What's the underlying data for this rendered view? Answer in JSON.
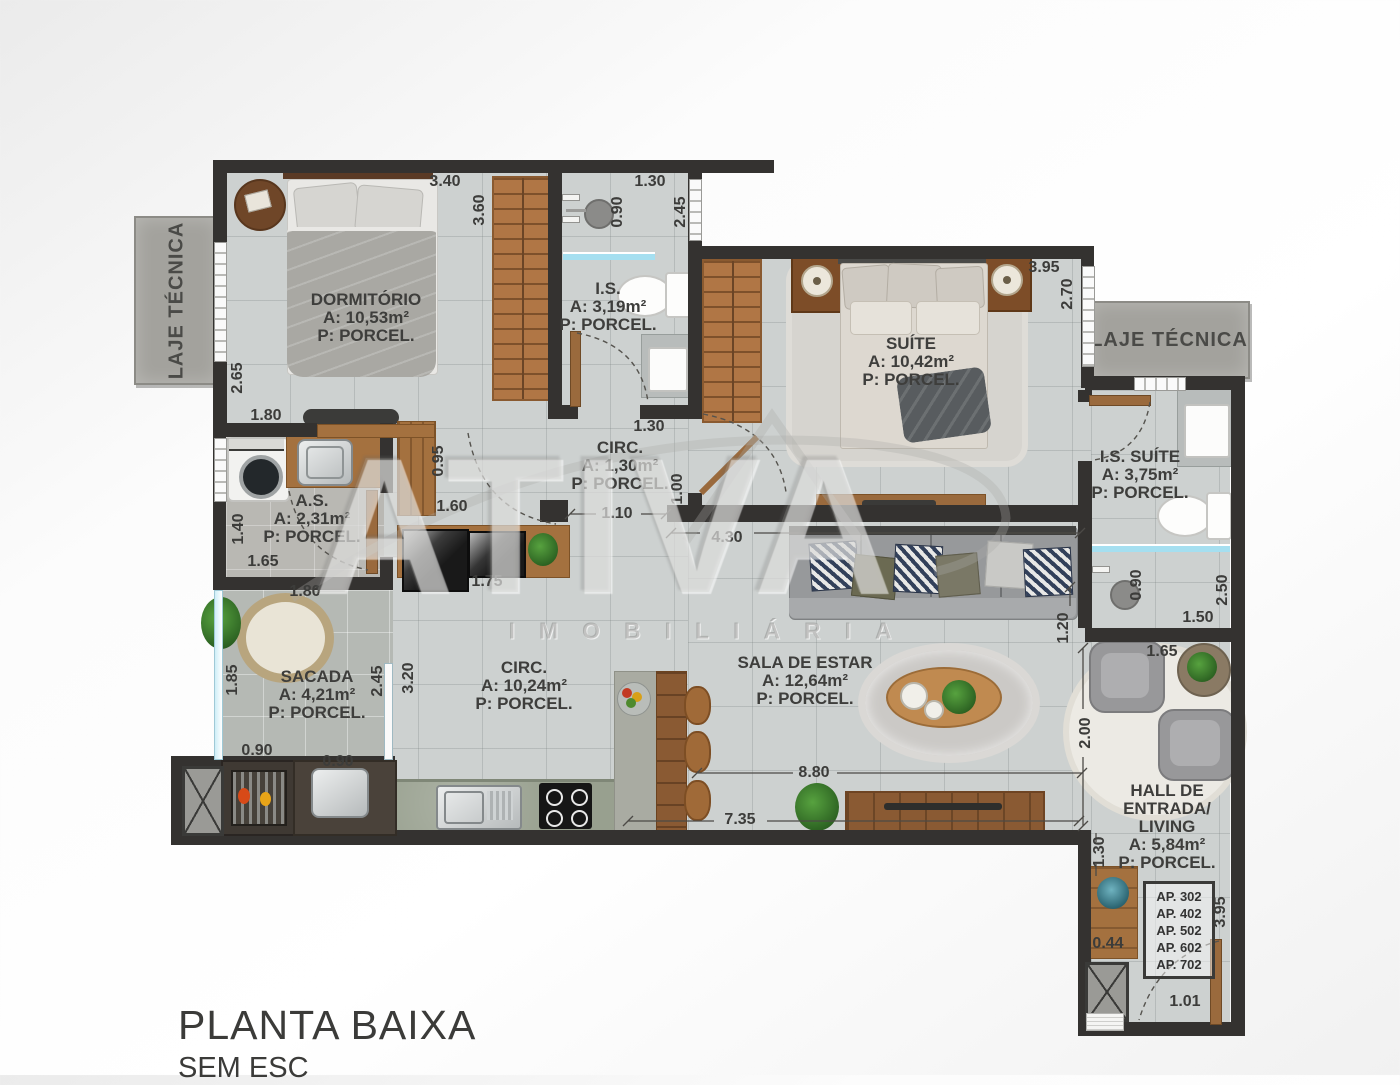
{
  "title": {
    "main": "PLANTA BAIXA",
    "sub": "SEM ESC"
  },
  "watermark": {
    "name": "ATIVA",
    "subtitle": "IMOBILIÁRIA"
  },
  "laje_tecnica": {
    "left": "LAJE TÉCNICA",
    "right": "LAJE TÉCNICA"
  },
  "apartment_list": [
    "AP. 302",
    "AP. 402",
    "AP. 502",
    "AP. 602",
    "AP. 702"
  ],
  "rooms": [
    {
      "id": "dormitorio",
      "lines": [
        "DORMITÓRIO",
        "A: 10,53m²",
        "P: PORCEL."
      ],
      "x": 366,
      "y": 318
    },
    {
      "id": "is",
      "lines": [
        "I.S.",
        "A: 3,19m²",
        "P: PORCEL."
      ],
      "x": 608,
      "y": 307
    },
    {
      "id": "suite",
      "lines": [
        "SUÍTE",
        "A: 10,42m²",
        "P: PORCEL."
      ],
      "x": 911,
      "y": 362
    },
    {
      "id": "circ-small",
      "lines": [
        "CIRC.",
        "A: 1,30m²",
        "P: PORCEL."
      ],
      "x": 620,
      "y": 466
    },
    {
      "id": "as",
      "lines": [
        "A.S.",
        "A: 2,31m²",
        "P: PORCEL."
      ],
      "x": 312,
      "y": 519
    },
    {
      "id": "is-suite",
      "lines": [
        "I.S. SUÍTE",
        "A: 3,75m²",
        "P: PORCEL."
      ],
      "x": 1140,
      "y": 475
    },
    {
      "id": "sacada",
      "lines": [
        "SACADA",
        "A: 4,21m²",
        "P: PORCEL."
      ],
      "x": 317,
      "y": 695
    },
    {
      "id": "circ-main",
      "lines": [
        "CIRC.",
        "A: 10,24m²",
        "P: PORCEL."
      ],
      "x": 524,
      "y": 686
    },
    {
      "id": "sala-de-estar",
      "lines": [
        "SALA DE ESTAR",
        "A: 12,64m²",
        "P: PORCEL."
      ],
      "x": 805,
      "y": 681
    },
    {
      "id": "hall",
      "lines": [
        "HALL DE",
        "ENTRADA/",
        "LIVING",
        "A: 5,84m²",
        "P: PORCEL."
      ],
      "x": 1167,
      "y": 827
    }
  ],
  "dimensions": [
    {
      "v": "3.40",
      "x": 445,
      "y": 182,
      "rot": 0
    },
    {
      "v": "3.60",
      "x": 480,
      "y": 210,
      "rot": 90
    },
    {
      "v": "1.30",
      "x": 650,
      "y": 182,
      "rot": 0
    },
    {
      "v": "0.90",
      "x": 618,
      "y": 212,
      "rot": 90
    },
    {
      "v": "2.45",
      "x": 681,
      "y": 212,
      "rot": 90
    },
    {
      "v": "3.95",
      "x": 1044,
      "y": 268,
      "rot": 0
    },
    {
      "v": "2.70",
      "x": 1068,
      "y": 294,
      "rot": 90
    },
    {
      "v": "2.65",
      "x": 238,
      "y": 378,
      "rot": 90
    },
    {
      "v": "1.80",
      "x": 266,
      "y": 416,
      "rot": 0
    },
    {
      "v": "1.30",
      "x": 649,
      "y": 427,
      "rot": 0
    },
    {
      "v": "0.95",
      "x": 439,
      "y": 461,
      "rot": 90
    },
    {
      "v": "1.60",
      "x": 452,
      "y": 507,
      "rot": 0
    },
    {
      "v": "1.00",
      "x": 678,
      "y": 489,
      "rot": 90
    },
    {
      "v": "1.10",
      "x": 617,
      "y": 514,
      "rot": 0
    },
    {
      "v": "4.30",
      "x": 727,
      "y": 538,
      "rot": 0
    },
    {
      "v": "1.40",
      "x": 239,
      "y": 529,
      "rot": 90
    },
    {
      "v": "1.65",
      "x": 263,
      "y": 562,
      "rot": 0
    },
    {
      "v": "1.80",
      "x": 305,
      "y": 592,
      "rot": 0
    },
    {
      "v": "1.75",
      "x": 487,
      "y": 582,
      "rot": 0
    },
    {
      "v": "1.85",
      "x": 233,
      "y": 680,
      "rot": 90
    },
    {
      "v": "2.45",
      "x": 378,
      "y": 681,
      "rot": 90
    },
    {
      "v": "3.20",
      "x": 409,
      "y": 678,
      "rot": 90
    },
    {
      "v": "0.90",
      "x": 257,
      "y": 751,
      "rot": 0
    },
    {
      "v": "0.90",
      "x": 338,
      "y": 762,
      "rot": 0
    },
    {
      "v": "1.20",
      "x": 1064,
      "y": 628,
      "rot": 90
    },
    {
      "v": "0.90",
      "x": 1137,
      "y": 585,
      "rot": 90
    },
    {
      "v": "2.50",
      "x": 1223,
      "y": 590,
      "rot": 90
    },
    {
      "v": "1.50",
      "x": 1198,
      "y": 618,
      "rot": 0
    },
    {
      "v": "1.65",
      "x": 1162,
      "y": 652,
      "rot": 0
    },
    {
      "v": "2.00",
      "x": 1086,
      "y": 733,
      "rot": 90
    },
    {
      "v": "8.80",
      "x": 814,
      "y": 773,
      "rot": 0
    },
    {
      "v": "7.35",
      "x": 740,
      "y": 820,
      "rot": 0
    },
    {
      "v": "1.30",
      "x": 1100,
      "y": 852,
      "rot": 90
    },
    {
      "v": "0.44",
      "x": 1108,
      "y": 944,
      "rot": 0
    },
    {
      "v": "3.95",
      "x": 1221,
      "y": 912,
      "rot": 90
    },
    {
      "v": "1.01",
      "x": 1185,
      "y": 1002,
      "rot": 0
    }
  ],
  "colors": {
    "wall": "#343230",
    "floor_tile": "#cdd1d0",
    "balcony_floor": "#b5b9b4",
    "wood": "#a4713f",
    "glass": "#a5dff0",
    "label_text": "#3e3e3c"
  }
}
